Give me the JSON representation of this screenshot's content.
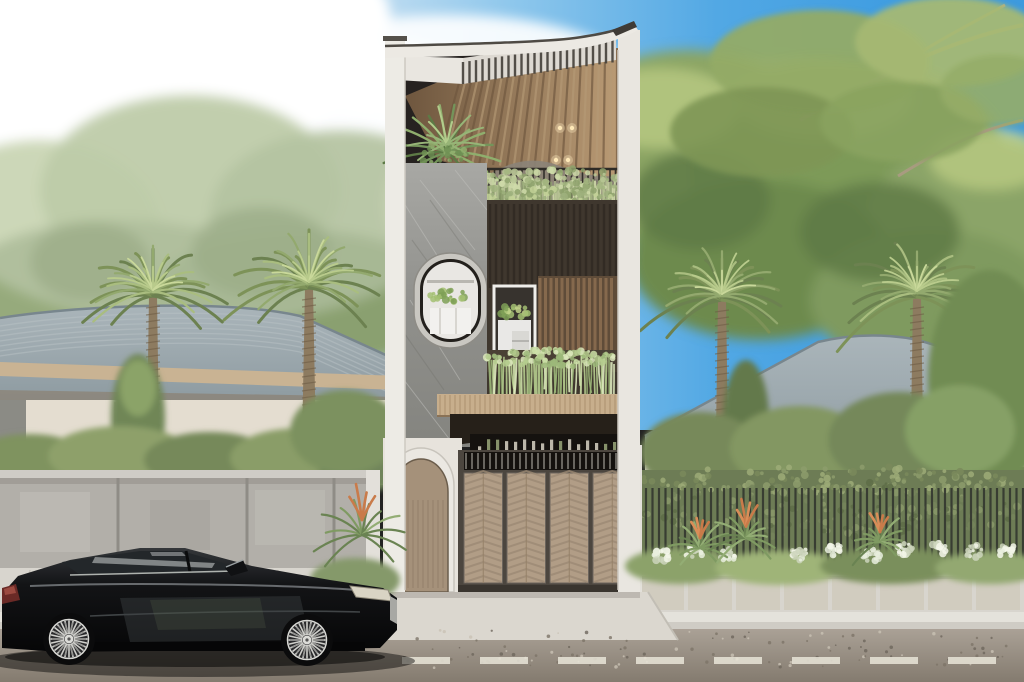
{
  "scene": {
    "description_label": "architectural-exterior-render",
    "palette": {
      "sky_pale": "#e9f1f7",
      "sky_blue": "#3f9de1",
      "cloud_white": "#ffffff",
      "tree_green": "#8aa06a",
      "tree_dark": "#5e7a48",
      "tree_light": "#b7c896",
      "palm_frond": "#93a96e",
      "palm_frond_light": "#b9cb8c",
      "palm_trunk": "#8d7b60",
      "roof_gray": "#97a4aa",
      "fascia_wood": "#c9b393",
      "house_cream": "#e4ddd0",
      "facade_white": "#ebe8e2",
      "stone_gray": "#9a9a96",
      "ceiling_wood": "#a08263",
      "vine_green": "#b6c693",
      "fern_green": "#c6d6a0",
      "planter_dark": "#4a4034",
      "canopy_dark": "#262019",
      "gate_wood": "#b19d86",
      "gate_frame": "#4c463f",
      "door_wood": "#a5917a",
      "concrete_wall": "#b2afa9",
      "hedge_green": "#6d7c55",
      "fence_dark": "#343830",
      "flower_white": "#e9eede",
      "flower_orange": "#c97b4a",
      "sidewalk": "#d8d5ce",
      "curb": "#e4e2db",
      "street": "#a29a8e",
      "street_dark": "#877e72",
      "lane_dash": "#e9e5d8",
      "car_black": "#0d0d0f",
      "car_highlight": "#7d8184",
      "wheel_silver": "#cfcfcb",
      "taillight_red": "#6a2a26",
      "headlight": "#d9d4c4"
    },
    "palms": [
      {
        "cx": 153,
        "cy": 296,
        "r": 80,
        "tb": 560
      },
      {
        "cx": 309,
        "cy": 288,
        "r": 86,
        "tb": 498
      },
      {
        "cx": 722,
        "cy": 300,
        "r": 82,
        "tb": 562
      },
      {
        "cx": 917,
        "cy": 297,
        "r": 85,
        "tb": 558
      }
    ],
    "vines": {
      "x0": 483,
      "x1": 627,
      "yTop": 178,
      "lenMin": 55,
      "lenMax": 120,
      "step": 2,
      "colors": [
        "#b9c795",
        "#a2b47f",
        "#cfdaa9",
        "#8ea26c"
      ]
    },
    "ferns": {
      "x0": 489,
      "x1": 616,
      "yTop": 356,
      "lenMin": 25,
      "lenMax": 85,
      "step": 2.5,
      "colors": [
        "#cde0a8",
        "#b5cc8e",
        "#9cb779",
        "#dce8bc"
      ]
    },
    "railing": {
      "x0": 489,
      "x1": 616,
      "y": 169,
      "h": 37,
      "step": 5.5,
      "w": 1.6,
      "color": "#2e2b26"
    },
    "pergola": {
      "x0": 463,
      "x1": 616,
      "y0": 62,
      "y1": 40,
      "h": 22,
      "step": 6.5,
      "w": 2.4,
      "color": "#44403a"
    },
    "fence": {
      "x0": 646,
      "x1": 1023,
      "y": 488,
      "h": 92,
      "step": 6.5,
      "w": 2.2,
      "color": "#343830"
    },
    "transom": {
      "x0": 466,
      "x1": 628,
      "y": 453,
      "h": 16,
      "step": 6,
      "w": 1.5,
      "color": "#cfccc2"
    },
    "gate_panels": {
      "xs": [
        464,
        507,
        550,
        593
      ],
      "y": 473,
      "w": 38.5,
      "h": 110,
      "step": 7
    },
    "wheels": [
      {
        "cx": 69,
        "cy": 639
      },
      {
        "cx": 307,
        "cy": 640
      }
    ],
    "aloes": [
      {
        "cx": 362,
        "cy": 535,
        "s": 1.5
      },
      {
        "cx": 700,
        "cy": 548,
        "s": 1.0
      },
      {
        "cx": 746,
        "cy": 538,
        "s": 1.15
      },
      {
        "cx": 880,
        "cy": 542,
        "s": 1.0
      }
    ],
    "white_flowers": [
      660,
      694,
      728,
      800,
      836,
      872,
      906,
      940,
      974,
      1006
    ],
    "terrace_plant": {
      "cx": 447,
      "cy": 152
    },
    "oval_window": {
      "cx": 450,
      "cy": 300,
      "rx": 36,
      "ry": 47
    },
    "lights": [
      [
        560,
        128
      ],
      [
        572,
        128
      ],
      [
        556,
        160
      ],
      [
        568,
        160
      ]
    ],
    "street_speckles": {
      "x0": 400,
      "x1": 1020,
      "y0": 630,
      "y1": 668,
      "n": 120
    },
    "lane_dashes": {
      "x0": 402,
      "y": 657,
      "dash": 48,
      "gap": 30,
      "h": 7
    }
  }
}
